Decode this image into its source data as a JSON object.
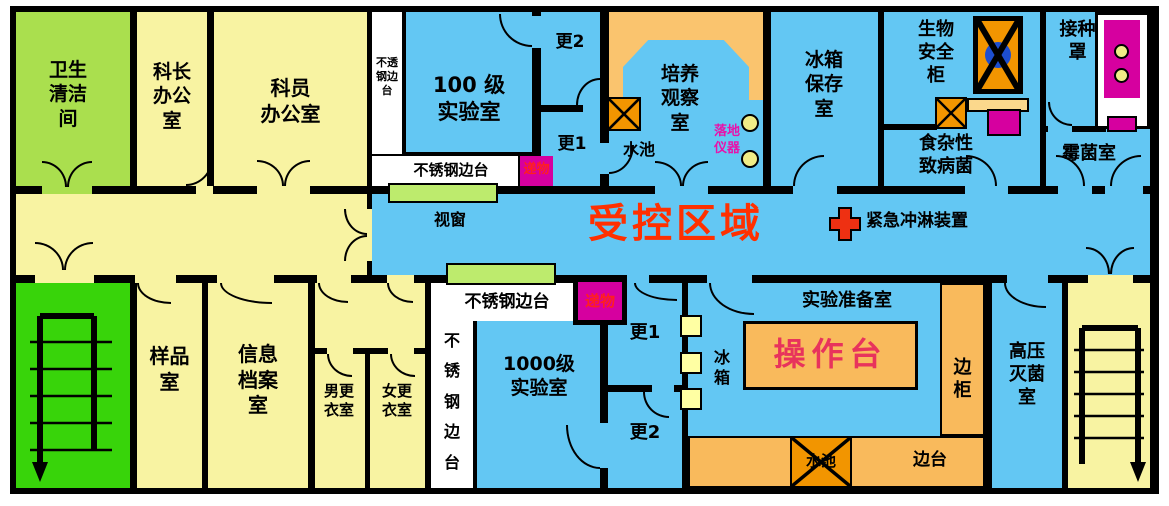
{
  "colors": {
    "wall": "#000000",
    "office_yellow": "#f8f3a2",
    "clean_green": "#aadf4e",
    "stair_green": "#38d40a",
    "bench_green": "#bdeb6d",
    "lab_blue": "#63c7f3",
    "bench_orange": "#f9ba5c",
    "culture_bench_orange": "#fac46e",
    "sink_orange": "#f29500",
    "wheat": "#fbd88c",
    "equip_yellow": "#ffffa3",
    "dot_yellow": "#f0ed86",
    "magenta": "#d6009f",
    "controlled_red": "#ff3000",
    "worktable_red": "#e8335c",
    "instrument_pink": "#e812aa",
    "pass_red": "#ff1f1f",
    "cabinet_blue": "#1d4ed0"
  },
  "icons": {
    "sink": "x-box",
    "emergency_shower": "red-cross",
    "biosafety_cabinet": "x-box-with-blue-circle",
    "stairs": "staircase-arrow-down",
    "pass_through": "magenta-box",
    "floor_instrument": "yellow-circles"
  },
  "labels": {
    "sanitation": "卫生\n清洁\n间",
    "chief_office": "科长\n办公\n室",
    "staff_office": "科员\n办公室",
    "steel_bench_small": "不透\n钢边\n台",
    "lab_100": "100 级\n实验室",
    "ss_bench_top": "不锈钢边台",
    "pass_box_top": "递物",
    "gown2_top": "更2",
    "gown1_top": "更1",
    "sink_top": "水池",
    "culture_room": "培养\n观察\n室",
    "floor_instrument": "落地\n仪器",
    "fridge_storage": "冰箱\n保存\n室",
    "biosafety_cabinet": "生物\n安全\n柜",
    "inoculation_hood": "接种\n罩",
    "foodborne": "食杂性\n致病菌",
    "mold_room": "霉菌室",
    "window": "视窗",
    "controlled_area": "受控区域",
    "emergency_shower": "紧急冲淋装置",
    "sample_room": "样品\n室",
    "info_archive": "信息\n档案\n室",
    "male_changing": "男更\n衣室",
    "female_changing": "女更\n衣室",
    "ss_bench_vertical": "不\n锈\n钢\n边\n台",
    "ss_bench_bottom": "不锈钢边台",
    "pass_box_bottom": "递物",
    "lab_1000": "1000级\n实验室",
    "gown1_bottom": "更1",
    "gown2_bottom": "更2",
    "fridge_small": "冰\n箱",
    "prep_room": "实验准备室",
    "worktable": "操作台",
    "side_cabinet": "边\n柜",
    "side_bench": "边台",
    "sink_bottom": "水池",
    "autoclave": "高压\n灭菌\n室"
  }
}
